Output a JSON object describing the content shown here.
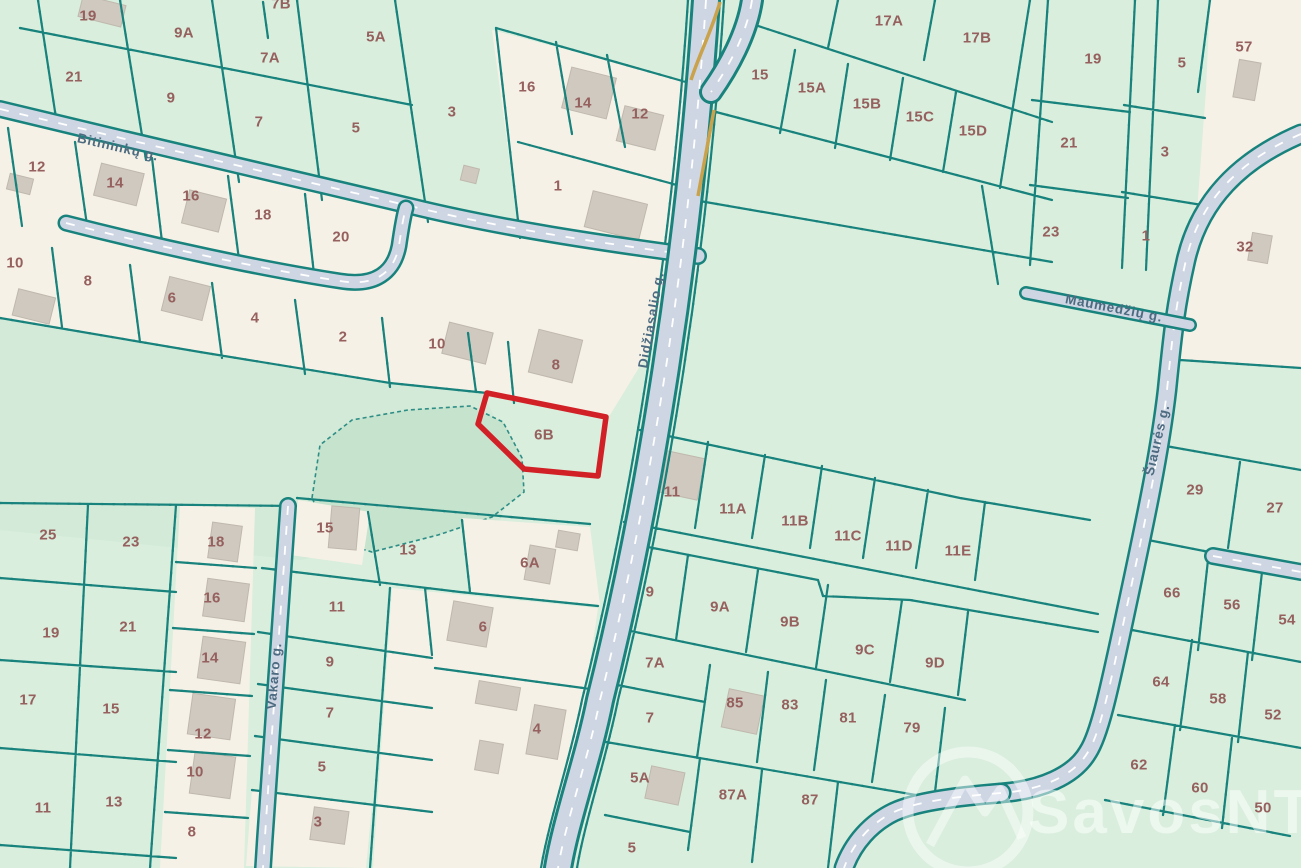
{
  "map": {
    "highlighted_parcel": {
      "label": "6B",
      "outline_color": "#d22027"
    },
    "watermark": "SavosNT",
    "colors": {
      "background_green": "#d9eedd",
      "field_green": "#d2ead7",
      "pond_green": "#c6e3ce",
      "built_cream": "#f6f1e7",
      "boundary_teal": "#18827c",
      "road_fill": "#ced6e4",
      "road_edge_yellow": "#c9a24b",
      "highlight_red": "#d22027",
      "parcel_label": "#95605d",
      "street_label": "#4d6b80",
      "building_grey": "#cfc9c0"
    },
    "street_labels": [
      {
        "text": "Bitininkų g.",
        "x": 118,
        "y": 147,
        "rot": 13
      },
      {
        "text": "Didžiasalio g.",
        "x": 651,
        "y": 320,
        "rot": -80
      },
      {
        "text": "Maumedžių g.",
        "x": 1114,
        "y": 308,
        "rot": 11
      },
      {
        "text": "Šiaurės g.",
        "x": 1157,
        "y": 440,
        "rot": -77
      },
      {
        "text": "Vakaro g.",
        "x": 274,
        "y": 676,
        "rot": -85
      }
    ],
    "parcel_labels": [
      {
        "t": "19",
        "x": 88,
        "y": 16
      },
      {
        "t": "9A",
        "x": 184,
        "y": 33
      },
      {
        "t": "7B",
        "x": 281,
        "y": 4
      },
      {
        "t": "7A",
        "x": 270,
        "y": 58
      },
      {
        "t": "21",
        "x": 74,
        "y": 77
      },
      {
        "t": "9",
        "x": 171,
        "y": 98
      },
      {
        "t": "7",
        "x": 259,
        "y": 122
      },
      {
        "t": "5A",
        "x": 376,
        "y": 37
      },
      {
        "t": "5",
        "x": 356,
        "y": 128
      },
      {
        "t": "3",
        "x": 452,
        "y": 112
      },
      {
        "t": "16",
        "x": 527,
        "y": 87
      },
      {
        "t": "14",
        "x": 583,
        "y": 103
      },
      {
        "t": "12",
        "x": 640,
        "y": 114
      },
      {
        "t": "1",
        "x": 558,
        "y": 186
      },
      {
        "t": "12",
        "x": 37,
        "y": 167
      },
      {
        "t": "14",
        "x": 115,
        "y": 183
      },
      {
        "t": "16",
        "x": 191,
        "y": 196
      },
      {
        "t": "18",
        "x": 263,
        "y": 215
      },
      {
        "t": "20",
        "x": 341,
        "y": 237
      },
      {
        "t": "10",
        "x": 15,
        "y": 263
      },
      {
        "t": "8",
        "x": 88,
        "y": 281
      },
      {
        "t": "6",
        "x": 172,
        "y": 298
      },
      {
        "t": "4",
        "x": 255,
        "y": 318
      },
      {
        "t": "2",
        "x": 343,
        "y": 337
      },
      {
        "t": "10",
        "x": 437,
        "y": 344
      },
      {
        "t": "8",
        "x": 556,
        "y": 365
      },
      {
        "t": "6B",
        "x": 544,
        "y": 435
      },
      {
        "t": "15",
        "x": 325,
        "y": 528
      },
      {
        "t": "13",
        "x": 408,
        "y": 550
      },
      {
        "t": "6A",
        "x": 530,
        "y": 563
      },
      {
        "t": "11",
        "x": 337,
        "y": 607
      },
      {
        "t": "6",
        "x": 483,
        "y": 627
      },
      {
        "t": "9",
        "x": 330,
        "y": 662
      },
      {
        "t": "7",
        "x": 330,
        "y": 713
      },
      {
        "t": "4",
        "x": 537,
        "y": 729
      },
      {
        "t": "5",
        "x": 322,
        "y": 767
      },
      {
        "t": "3",
        "x": 318,
        "y": 822
      },
      {
        "t": "25",
        "x": 48,
        "y": 535
      },
      {
        "t": "23",
        "x": 131,
        "y": 542
      },
      {
        "t": "18",
        "x": 216,
        "y": 542
      },
      {
        "t": "19",
        "x": 51,
        "y": 633
      },
      {
        "t": "21",
        "x": 128,
        "y": 627
      },
      {
        "t": "16",
        "x": 212,
        "y": 598
      },
      {
        "t": "17",
        "x": 28,
        "y": 700
      },
      {
        "t": "15",
        "x": 111,
        "y": 709
      },
      {
        "t": "14",
        "x": 210,
        "y": 658
      },
      {
        "t": "12",
        "x": 203,
        "y": 734
      },
      {
        "t": "11",
        "x": 43,
        "y": 808
      },
      {
        "t": "13",
        "x": 114,
        "y": 802
      },
      {
        "t": "10",
        "x": 195,
        "y": 772
      },
      {
        "t": "8",
        "x": 192,
        "y": 832
      },
      {
        "t": "15",
        "x": 760,
        "y": 75
      },
      {
        "t": "15A",
        "x": 812,
        "y": 88
      },
      {
        "t": "15B",
        "x": 867,
        "y": 104
      },
      {
        "t": "15C",
        "x": 920,
        "y": 117
      },
      {
        "t": "15D",
        "x": 973,
        "y": 131
      },
      {
        "t": "17A",
        "x": 889,
        "y": 21
      },
      {
        "t": "17B",
        "x": 977,
        "y": 38
      },
      {
        "t": "19",
        "x": 1093,
        "y": 59
      },
      {
        "t": "5",
        "x": 1182,
        "y": 63
      },
      {
        "t": "57",
        "x": 1244,
        "y": 47
      },
      {
        "t": "21",
        "x": 1069,
        "y": 143
      },
      {
        "t": "3",
        "x": 1165,
        "y": 152
      },
      {
        "t": "23",
        "x": 1051,
        "y": 232
      },
      {
        "t": "1",
        "x": 1146,
        "y": 236
      },
      {
        "t": "32",
        "x": 1245,
        "y": 247
      },
      {
        "t": "11",
        "x": 672,
        "y": 492
      },
      {
        "t": "11A",
        "x": 733,
        "y": 509
      },
      {
        "t": "11B",
        "x": 795,
        "y": 521
      },
      {
        "t": "11C",
        "x": 848,
        "y": 536
      },
      {
        "t": "11D",
        "x": 899,
        "y": 546
      },
      {
        "t": "11E",
        "x": 958,
        "y": 551
      },
      {
        "t": "9",
        "x": 650,
        "y": 592
      },
      {
        "t": "9A",
        "x": 720,
        "y": 607
      },
      {
        "t": "9B",
        "x": 790,
        "y": 622
      },
      {
        "t": "9C",
        "x": 865,
        "y": 650
      },
      {
        "t": "9D",
        "x": 935,
        "y": 663
      },
      {
        "t": "7A",
        "x": 655,
        "y": 663
      },
      {
        "t": "7",
        "x": 650,
        "y": 718
      },
      {
        "t": "85",
        "x": 735,
        "y": 703
      },
      {
        "t": "83",
        "x": 790,
        "y": 705
      },
      {
        "t": "81",
        "x": 848,
        "y": 718
      },
      {
        "t": "79",
        "x": 912,
        "y": 728
      },
      {
        "t": "5A",
        "x": 640,
        "y": 778
      },
      {
        "t": "87A",
        "x": 733,
        "y": 795
      },
      {
        "t": "87",
        "x": 810,
        "y": 800
      },
      {
        "t": "5",
        "x": 632,
        "y": 848
      },
      {
        "t": "29",
        "x": 1195,
        "y": 490
      },
      {
        "t": "27",
        "x": 1275,
        "y": 508
      },
      {
        "t": "66",
        "x": 1172,
        "y": 593
      },
      {
        "t": "56",
        "x": 1232,
        "y": 605
      },
      {
        "t": "54",
        "x": 1287,
        "y": 620
      },
      {
        "t": "64",
        "x": 1161,
        "y": 682
      },
      {
        "t": "58",
        "x": 1218,
        "y": 699
      },
      {
        "t": "52",
        "x": 1273,
        "y": 715
      },
      {
        "t": "62",
        "x": 1139,
        "y": 765
      },
      {
        "t": "60",
        "x": 1200,
        "y": 788
      },
      {
        "t": "50",
        "x": 1263,
        "y": 808
      }
    ]
  }
}
